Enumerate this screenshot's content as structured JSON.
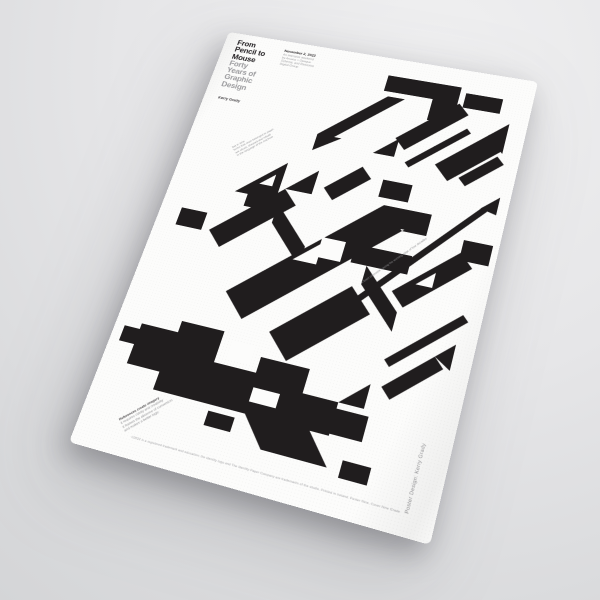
{
  "scene": {
    "backdrop_light": "#f0f0f1",
    "backdrop_dark": "#cfd0d2"
  },
  "poster": {
    "paper_color": "#fcfcfb",
    "ink_color": "#201d1e",
    "gray_text_color": "#98989b",
    "title_lines": [
      "From",
      "Pencil to",
      "Mouse"
    ],
    "subtitle_lines": [
      "Forty",
      "Years of",
      "Graphic",
      "Design"
    ],
    "author": "Kerry Grady",
    "date": "November 2, 2022",
    "event_lines": [
      "An intensive weekend",
      "by Arcana + Opaque",
      "Schema, and Resource",
      "Digital Group"
    ],
    "note_top_lines": [
      "Set in time",
      "forms that once belonged to paper",
      "are sliced, sheared and rebuilt",
      "in the language of the machine"
    ],
    "arrow_note": "A fixed silhouette tracing the working edge of four decades",
    "note_bottom_lines": [
      "References create imagery",
      "it requires clarity and creativity",
      "it frames the absence of convention",
      "and makes a better logic"
    ],
    "legal": "©2022 is a registered trademark and education; the identity logo and The Identity Paper Company are trademarks of the studio. Printed in Ireland. Poster Nine, Cover Nine Grade",
    "credit_vertical": "Poster Design: Kerry Grady"
  },
  "artwork": {
    "ink": "#201d1e",
    "paper": "#fcfcfb",
    "shapes": [
      {
        "f": "k",
        "p": "188,22 266,22 266,42 188,42"
      },
      {
        "f": "k",
        "p": "240,42 266,42 266,68 240,68"
      },
      {
        "f": "k",
        "p": "134,108 194,48 212,48 152,108"
      },
      {
        "f": "k",
        "p": "134,108 160,108 134,128"
      },
      {
        "f": "k",
        "p": "214,96 268,42 280,54 226,108"
      },
      {
        "f": "k",
        "p": "272,28 310,28 310,46 272,46"
      },
      {
        "f": "k",
        "p": "260,118 306,72 322,88 276,134"
      },
      {
        "f": "k",
        "p": "304,74 322,56 322,92"
      },
      {
        "f": "k",
        "p": "230,122 282,70 287,75 235,127"
      },
      {
        "f": "k",
        "p": "196,118 218,96 218,118"
      },
      {
        "f": "k",
        "p": "286,128 318,96 326,104 294,136"
      },
      {
        "f": "k",
        "p": "70,192 114,148 114,192"
      },
      {
        "f": "k",
        "p": "84,192 114,192 114,206 84,206"
      },
      {
        "f": "w",
        "p": "92,178 106,164 106,178"
      },
      {
        "f": "k",
        "p": "58,240 120,178 136,194 74,256"
      },
      {
        "f": "k",
        "p": "22,222 50,222 50,242 22,242"
      },
      {
        "f": "k",
        "p": "120,178 148,150 148,178"
      },
      {
        "f": "k",
        "p": "118,196 158,236 158,258 118,218"
      },
      {
        "f": "k",
        "p": "158,168 190,136 202,148 170,180"
      },
      {
        "f": "k",
        "p": "96,300 222,174 246,198 120,324"
      },
      {
        "f": "w",
        "p": "150,252 174,228 174,252"
      },
      {
        "f": "w",
        "p": "172,222 196,222 196,244 172,244"
      },
      {
        "f": "k",
        "p": "222,174 270,174 270,196 222,196"
      },
      {
        "f": "k",
        "p": "206,222 262,222 262,242 206,242"
      },
      {
        "f": "k",
        "p": "246,198 270,174 270,198"
      },
      {
        "f": "k",
        "p": "214,146 244,146 244,166 214,166"
      },
      {
        "f": "k",
        "p": "222,242 262,282 262,302 222,262"
      },
      {
        "f": "k",
        "p": "193,317 207,287 221,301"
      },
      {
        "f": "k",
        "p": "210,289 316,155 321,159 215,293"
      },
      {
        "f": "k",
        "p": "314,157 330,141 330,161"
      },
      {
        "f": "k",
        "p": "252,262 306,208 320,222 266,276"
      },
      {
        "f": "k",
        "p": "306,194 334,194 334,216 306,216"
      },
      {
        "f": "w",
        "p": "272,250 288,234 288,250"
      },
      {
        "f": "k",
        "p": "262,330 322,270 328,276 268,336"
      },
      {
        "f": "k",
        "p": "150,330 214,266 238,290 174,354"
      },
      {
        "f": "k",
        "p": "64,340 108,340 108,372 150,372 150,356 198,356 198,380 232,380 232,412 60,412 60,394 26,394 26,352 64,352"
      },
      {
        "f": "k",
        "p": "152,412 214,412 238,440 176,440"
      },
      {
        "f": "w",
        "p": "118,348 142,348 142,366 118,366"
      },
      {
        "f": "w",
        "p": "152,386 178,386 178,400 152,400"
      },
      {
        "f": "k",
        "p": "10,358 26,358 26,374 10,374"
      },
      {
        "f": "k",
        "p": "232,386 262,386 262,410 232,410"
      },
      {
        "f": "k",
        "p": "232,380 256,356 256,380"
      },
      {
        "f": "k",
        "p": "250,430 276,430 276,446 250,446"
      },
      {
        "f": "k",
        "p": "118,418 144,418 144,432 118,432"
      },
      {
        "f": "k",
        "p": "266,356 306,316 316,326 276,366"
      },
      {
        "f": "k",
        "p": "306,316 322,300 322,326"
      }
    ]
  }
}
